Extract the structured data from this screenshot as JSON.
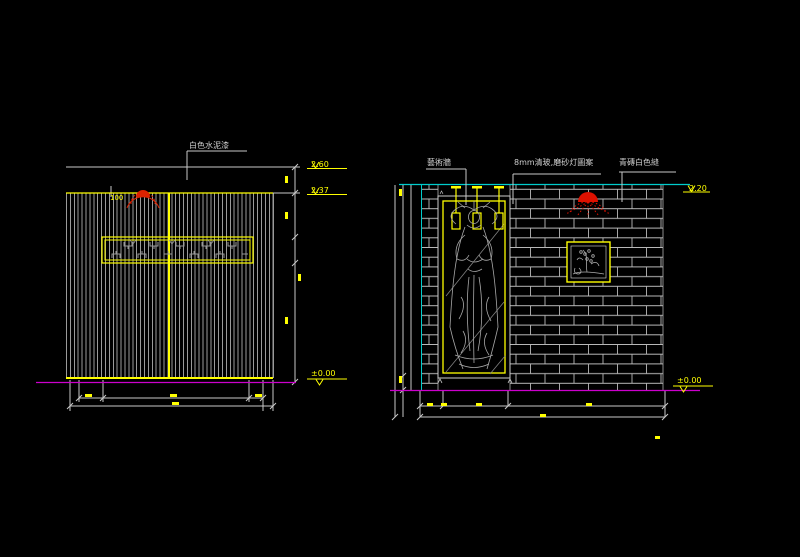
{
  "left": {
    "paint_label": "白色水泥漆",
    "radius_label": "100",
    "levels": {
      "top": "2.60",
      "band": "2.37",
      "ground": "±0.00"
    }
  },
  "right": {
    "art_label": "藝術牆",
    "glass_label": "8mm清玻,磨砂灯圖案",
    "brick_label": "青磚白色縫",
    "levels": {
      "top": "2.20",
      "ground": "±0.00"
    }
  },
  "colors": {
    "background": "#000000",
    "linework": "#c8c8c8",
    "dimension_accent": "#ffff00",
    "ground_line": "#cc00cc",
    "ceiling_line": "#00cccc",
    "lamp_symbol": "#dd1100"
  }
}
